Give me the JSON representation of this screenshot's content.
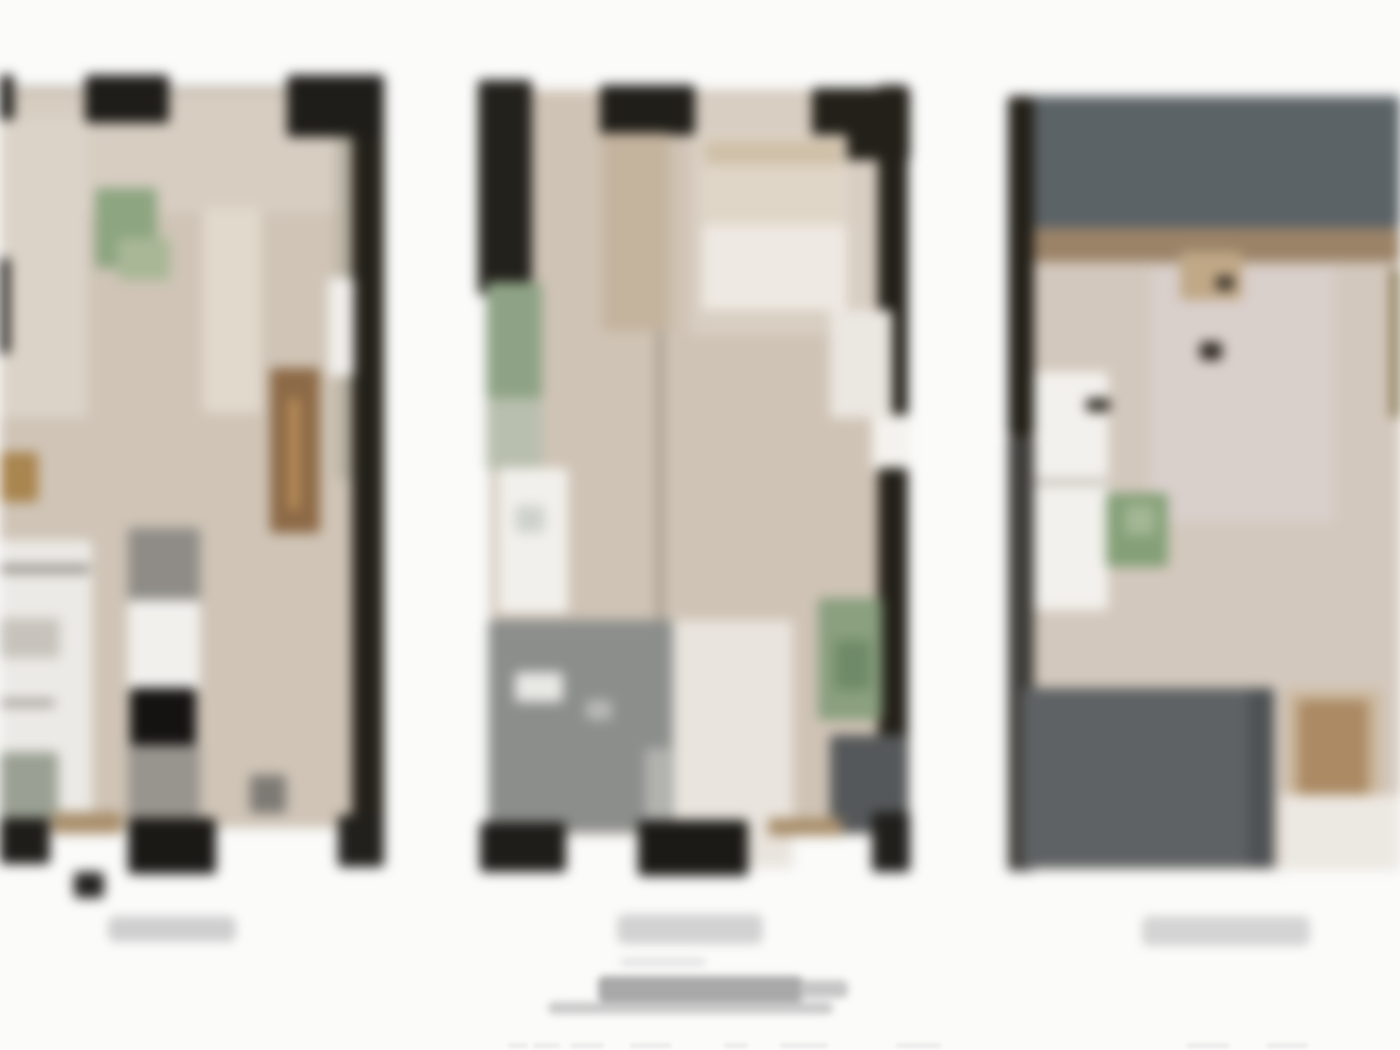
{
  "sheet": {
    "background": "#fbfbfa",
    "description_name": "blurred-architectural-floorplan-sheet-with-three-unit-plans",
    "text_legible": false
  },
  "palette": {
    "wall_black": "#1f1d19",
    "wall_dark": "#23211c",
    "floor_beige": "#cfc4b6",
    "floor_light": "#d8cec2",
    "floor_pink": "#d9cfcb",
    "slate_band": "#5c6367",
    "terrace_gray": "#8c8e8c",
    "block_gray": "#5e6264",
    "plant_green": "#8aa07f",
    "cabinet_brown": "#8d6a47",
    "sill_tan": "#a98f6c",
    "fixture_white": "#f2f0ec",
    "caption_gray": "#d0d0d0",
    "title_gray": "#a8a8a8"
  },
  "plans": [
    {
      "id": "unit-plan-1",
      "clipped_edge": "left",
      "caption_text_legible": false,
      "rects": [
        {
          "n": "floor",
          "x": 0,
          "y": 88,
          "w": 352,
          "h": 740,
          "c": "#cfc4b6"
        },
        {
          "n": "floor-hall-light",
          "x": 10,
          "y": 95,
          "w": 340,
          "h": 118,
          "c": "#d7cdc1"
        },
        {
          "n": "floor-upper-left-light",
          "x": 0,
          "y": 118,
          "w": 88,
          "h": 300,
          "c": "#dbd3c8"
        },
        {
          "n": "balcony-strip",
          "x": 336,
          "y": 120,
          "w": 24,
          "h": 360,
          "c": "#b9b3a4"
        },
        {
          "n": "right-wall",
          "x": 352,
          "y": 75,
          "w": 32,
          "h": 790,
          "c": "#232019"
        },
        {
          "n": "right-wall-door-white",
          "x": 328,
          "y": 278,
          "w": 26,
          "h": 98,
          "c": "#f1efec"
        },
        {
          "n": "top-wall-seg-a",
          "x": 0,
          "y": 75,
          "w": 14,
          "h": 45,
          "c": "#1f1d19"
        },
        {
          "n": "window-lintel-line",
          "x": 12,
          "y": 86,
          "w": 276,
          "h": 4,
          "c": "#b9b4ac"
        },
        {
          "n": "top-wall-seg-b",
          "x": 85,
          "y": 75,
          "w": 84,
          "h": 48,
          "c": "#1f1d19"
        },
        {
          "n": "top-wall-corner",
          "x": 287,
          "y": 75,
          "w": 97,
          "h": 62,
          "c": "#1f1d19"
        },
        {
          "n": "left-edge-wall-bit",
          "x": 0,
          "y": 258,
          "w": 10,
          "h": 96,
          "c": "#2a2723"
        },
        {
          "n": "left-edge-wall-bit-2",
          "x": 0,
          "y": 575,
          "w": 8,
          "h": 78,
          "c": "#8e8a82"
        },
        {
          "n": "dining-table",
          "x": 203,
          "y": 208,
          "w": 58,
          "h": 205,
          "c": "#e2d9cd"
        },
        {
          "n": "plant",
          "x": 95,
          "y": 188,
          "w": 62,
          "h": 80,
          "c": "#8da581"
        },
        {
          "n": "plant-light",
          "x": 118,
          "y": 238,
          "w": 52,
          "h": 42,
          "c": "#a9b796"
        },
        {
          "n": "wardrobe-brown",
          "x": 270,
          "y": 368,
          "w": 50,
          "h": 165,
          "c": "#8d6a47"
        },
        {
          "n": "wardrobe-seam",
          "x": 290,
          "y": 398,
          "w": 8,
          "h": 112,
          "c": "#c79a5e"
        },
        {
          "n": "ceiling-light-gold",
          "x": 0,
          "y": 452,
          "w": 38,
          "h": 50,
          "c": "#a9854f"
        },
        {
          "n": "kitchen-column-gray",
          "x": 128,
          "y": 528,
          "w": 72,
          "h": 78,
          "c": "#8f8c87"
        },
        {
          "n": "kitchen-column-white",
          "x": 128,
          "y": 600,
          "w": 72,
          "h": 90,
          "c": "#f2f0ed"
        },
        {
          "n": "kitchen-column-black",
          "x": 130,
          "y": 688,
          "w": 66,
          "h": 60,
          "c": "#151312"
        },
        {
          "n": "kitchen-column-gray-2",
          "x": 128,
          "y": 745,
          "w": 72,
          "h": 85,
          "c": "#98948e"
        },
        {
          "n": "bath-white-block",
          "x": 0,
          "y": 540,
          "w": 92,
          "h": 290,
          "c": "#eceae6"
        },
        {
          "n": "bath-divider",
          "x": 0,
          "y": 565,
          "w": 90,
          "h": 8,
          "c": "#8b8780"
        },
        {
          "n": "bath-fixture-gray",
          "x": 0,
          "y": 618,
          "w": 60,
          "h": 40,
          "c": "#c7c3bc"
        },
        {
          "n": "bath-divider-2",
          "x": 0,
          "y": 700,
          "w": 55,
          "h": 6,
          "c": "#8b8780"
        },
        {
          "n": "bath-graygreen-block",
          "x": 0,
          "y": 752,
          "w": 58,
          "h": 70,
          "c": "#9aa093"
        },
        {
          "n": "window-sill-tan",
          "x": 52,
          "y": 812,
          "w": 70,
          "h": 22,
          "c": "#a98f6c"
        },
        {
          "n": "furniture-gray-blob",
          "x": 250,
          "y": 775,
          "w": 36,
          "h": 38,
          "c": "#7d7a75"
        },
        {
          "n": "bottom-wall-seg-a",
          "x": 0,
          "y": 818,
          "w": 50,
          "h": 46,
          "c": "#1f1d19"
        },
        {
          "n": "bottom-wall-seg-b",
          "x": 128,
          "y": 818,
          "w": 88,
          "h": 56,
          "c": "#1b1916"
        },
        {
          "n": "bottom-wall-corner",
          "x": 338,
          "y": 815,
          "w": 46,
          "h": 52,
          "c": "#21201c"
        },
        {
          "n": "detached-wall-square",
          "x": 74,
          "y": 872,
          "w": 30,
          "h": 26,
          "c": "#242220"
        }
      ]
    },
    {
      "id": "unit-plan-2",
      "clipped_edge": "none",
      "caption_text_legible": false,
      "rects": [
        {
          "n": "floor",
          "x": 490,
          "y": 90,
          "w": 402,
          "h": 745,
          "c": "#cfc3b5"
        },
        {
          "n": "floor-bedroom-light",
          "x": 690,
          "y": 95,
          "w": 200,
          "h": 240,
          "c": "#d8cec2"
        },
        {
          "n": "top-left-corner-wall",
          "x": 478,
          "y": 80,
          "w": 54,
          "h": 215,
          "c": "#23211c"
        },
        {
          "n": "plant-strip",
          "x": 486,
          "y": 282,
          "w": 56,
          "h": 118,
          "c": "#8ea385"
        },
        {
          "n": "plant-strip-light",
          "x": 486,
          "y": 398,
          "w": 56,
          "h": 72,
          "c": "#b9bfae"
        },
        {
          "n": "top-wall-seg-mid",
          "x": 600,
          "y": 85,
          "w": 95,
          "h": 50,
          "c": "#201e19"
        },
        {
          "n": "tall-cabinet-tan",
          "x": 602,
          "y": 133,
          "w": 68,
          "h": 198,
          "c": "#c4b49e"
        },
        {
          "n": "top-right-corner-wall",
          "x": 812,
          "y": 88,
          "w": 98,
          "h": 72,
          "c": "#232019"
        },
        {
          "n": "right-wall-upper",
          "x": 878,
          "y": 85,
          "w": 30,
          "h": 332,
          "c": "#232019"
        },
        {
          "n": "right-wall-door-white",
          "x": 872,
          "y": 415,
          "w": 38,
          "h": 55,
          "c": "#f4f2ee"
        },
        {
          "n": "right-wall-lower",
          "x": 878,
          "y": 468,
          "w": 30,
          "h": 402,
          "c": "#232019"
        },
        {
          "n": "bed-base",
          "x": 702,
          "y": 135,
          "w": 145,
          "h": 175,
          "c": "#e0d6c8"
        },
        {
          "n": "bed-pillow-band",
          "x": 705,
          "y": 140,
          "w": 138,
          "h": 25,
          "c": "#cfc0a8"
        },
        {
          "n": "bed-sheet-white",
          "x": 702,
          "y": 225,
          "w": 145,
          "h": 85,
          "c": "#eee9e2"
        },
        {
          "n": "wardrobe-white",
          "x": 830,
          "y": 310,
          "w": 62,
          "h": 108,
          "c": "#ebe7e1"
        },
        {
          "n": "partition-line",
          "x": 656,
          "y": 330,
          "w": 8,
          "h": 500,
          "c": "#a99f92"
        },
        {
          "n": "kitchen-counter-white",
          "x": 498,
          "y": 468,
          "w": 70,
          "h": 145,
          "c": "#f2f0ec"
        },
        {
          "n": "kitchen-sink-gray",
          "x": 515,
          "y": 505,
          "w": 30,
          "h": 28,
          "c": "#cfd2cc"
        },
        {
          "n": "terrace-gray-block",
          "x": 488,
          "y": 620,
          "w": 185,
          "h": 212,
          "c": "#8c8e8c"
        },
        {
          "n": "terrace-white-speck",
          "x": 515,
          "y": 672,
          "w": 48,
          "h": 30,
          "c": "#e8e8e4"
        },
        {
          "n": "terrace-speck-2",
          "x": 586,
          "y": 700,
          "w": 26,
          "h": 20,
          "c": "#b9bab6"
        },
        {
          "n": "terrace-light-column",
          "x": 645,
          "y": 748,
          "w": 26,
          "h": 84,
          "c": "#b2b2ae"
        },
        {
          "n": "floor-light-path",
          "x": 673,
          "y": 620,
          "w": 120,
          "h": 248,
          "c": "#e9e4dd"
        },
        {
          "n": "plant-right",
          "x": 818,
          "y": 598,
          "w": 64,
          "h": 122,
          "c": "#8aa07f"
        },
        {
          "n": "plant-right-core",
          "x": 835,
          "y": 640,
          "w": 36,
          "h": 50,
          "c": "#6f8a68"
        },
        {
          "n": "couch-dark",
          "x": 830,
          "y": 735,
          "w": 76,
          "h": 98,
          "c": "#55585a"
        },
        {
          "n": "window-sill-tan",
          "x": 768,
          "y": 818,
          "w": 74,
          "h": 18,
          "c": "#a98f6c"
        },
        {
          "n": "bottom-wall-seg-a",
          "x": 480,
          "y": 822,
          "w": 86,
          "h": 50,
          "c": "#1f1d19"
        },
        {
          "n": "bottom-wall-seg-b",
          "x": 638,
          "y": 820,
          "w": 110,
          "h": 56,
          "c": "#1b1a16"
        },
        {
          "n": "bottom-wall-corner",
          "x": 872,
          "y": 812,
          "w": 38,
          "h": 60,
          "c": "#201f1b"
        }
      ]
    },
    {
      "id": "unit-plan-3",
      "clipped_edge": "right",
      "caption_text_legible": false,
      "rects": [
        {
          "n": "slate-roof-band",
          "x": 1030,
          "y": 96,
          "w": 370,
          "h": 132,
          "c": "#5c6367"
        },
        {
          "n": "transition-strip-brown",
          "x": 1030,
          "y": 228,
          "w": 370,
          "h": 36,
          "c": "#9b8368"
        },
        {
          "n": "floor",
          "x": 1030,
          "y": 262,
          "w": 370,
          "h": 608,
          "c": "#d3c8bd"
        },
        {
          "n": "bed-area-pink",
          "x": 1150,
          "y": 268,
          "w": 185,
          "h": 255,
          "c": "#d9cfcb"
        },
        {
          "n": "bed-headboard-tan",
          "x": 1180,
          "y": 252,
          "w": 62,
          "h": 48,
          "c": "#c0a887"
        },
        {
          "n": "dark-speck-a",
          "x": 1216,
          "y": 276,
          "w": 18,
          "h": 14,
          "c": "#3b332a"
        },
        {
          "n": "dark-speck-b",
          "x": 1200,
          "y": 342,
          "w": 22,
          "h": 18,
          "c": "#2f2921"
        },
        {
          "n": "left-wall-upper",
          "x": 1008,
          "y": 96,
          "w": 26,
          "h": 340,
          "c": "#232019"
        },
        {
          "n": "left-wall-lower",
          "x": 1008,
          "y": 436,
          "w": 26,
          "h": 435,
          "c": "#3f3d39"
        },
        {
          "n": "counter-white",
          "x": 1034,
          "y": 372,
          "w": 74,
          "h": 238,
          "c": "#f3f1ed"
        },
        {
          "n": "counter-divider",
          "x": 1034,
          "y": 478,
          "w": 74,
          "h": 8,
          "c": "#c9c5be"
        },
        {
          "n": "counter-dark-mark",
          "x": 1086,
          "y": 398,
          "w": 24,
          "h": 14,
          "c": "#37332c"
        },
        {
          "n": "plant",
          "x": 1106,
          "y": 493,
          "w": 62,
          "h": 74,
          "c": "#85a078"
        },
        {
          "n": "plant-light",
          "x": 1125,
          "y": 505,
          "w": 30,
          "h": 30,
          "c": "#a3b795"
        },
        {
          "n": "console-surround-tan",
          "x": 1286,
          "y": 690,
          "w": 95,
          "h": 115,
          "c": "#cbb89e"
        },
        {
          "n": "console-tan",
          "x": 1298,
          "y": 700,
          "w": 70,
          "h": 95,
          "c": "#ab8a64"
        },
        {
          "n": "terrace-dark-block",
          "x": 1022,
          "y": 688,
          "w": 252,
          "h": 180,
          "c": "#5e6264"
        },
        {
          "n": "terrace-dark-edge",
          "x": 1248,
          "y": 688,
          "w": 26,
          "h": 180,
          "c": "#4e5254"
        },
        {
          "n": "floor-light-bottom-right",
          "x": 1280,
          "y": 795,
          "w": 120,
          "h": 75,
          "c": "#ece8e2"
        },
        {
          "n": "olive-strip-right-edge",
          "x": 1390,
          "y": 268,
          "w": 10,
          "h": 150,
          "c": "#8a7a55"
        }
      ]
    }
  ],
  "annotations": {
    "captions": [
      {
        "id": "caption-unit-1",
        "x": 108,
        "y": 916,
        "w": 128,
        "h": 26,
        "c": "#cfcfcf",
        "text_legible": false
      },
      {
        "id": "caption-unit-2",
        "x": 617,
        "y": 914,
        "w": 146,
        "h": 30,
        "c": "#d2d2d2",
        "text_legible": false
      },
      {
        "id": "caption-unit-3",
        "x": 1142,
        "y": 916,
        "w": 168,
        "h": 30,
        "c": "#d4d4d4",
        "text_legible": false
      }
    ],
    "title_block": {
      "lines": [
        {
          "id": "title-pre-line",
          "x": 620,
          "y": 958,
          "w": 86,
          "h": 8,
          "c": "#e3e3e3"
        },
        {
          "id": "title-main-line",
          "x": 598,
          "y": 976,
          "w": 205,
          "h": 26,
          "c": "#a8a8a8"
        },
        {
          "id": "title-main-tail",
          "x": 800,
          "y": 980,
          "w": 48,
          "h": 18,
          "c": "#c6c6c6"
        },
        {
          "id": "title-sub-line",
          "x": 548,
          "y": 1002,
          "w": 285,
          "h": 12,
          "c": "#c9c9c9"
        }
      ],
      "text_legible": false
    },
    "scale_marks": {
      "y": 1043,
      "h": 5,
      "c": "#ececec",
      "marks": [
        {
          "x": 508,
          "w": 20
        },
        {
          "x": 533,
          "w": 27
        },
        {
          "x": 570,
          "w": 34
        },
        {
          "x": 630,
          "w": 41
        },
        {
          "x": 724,
          "w": 24
        },
        {
          "x": 780,
          "w": 48
        },
        {
          "x": 896,
          "w": 45
        },
        {
          "x": 1186,
          "w": 44
        },
        {
          "x": 1266,
          "w": 42
        }
      ]
    }
  },
  "render": {
    "blur_plans_px": 6,
    "blur_captions_px": 5,
    "blur_title_px": 4,
    "blur_marks_px": 1.5
  }
}
